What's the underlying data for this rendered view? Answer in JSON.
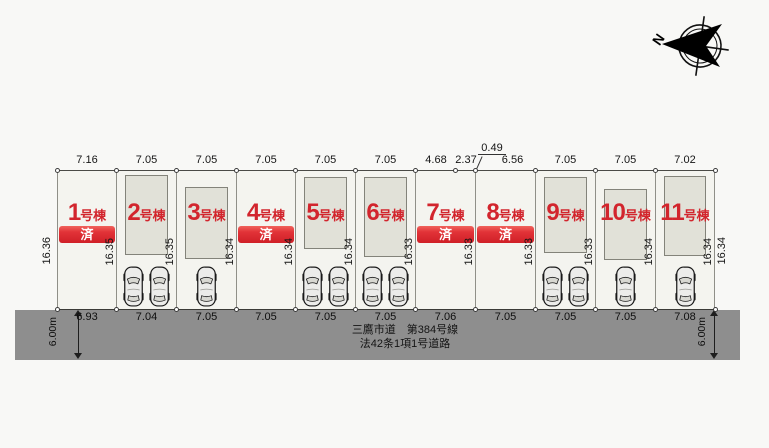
{
  "compass": {
    "label": "N"
  },
  "road": {
    "line1": "三鷹市道　第384号線",
    "line2": "法42条1項1号道路",
    "width_left": "6.00m",
    "width_right": "6.00m"
  },
  "outer_dims": {
    "left": "16.36",
    "right": "16.34"
  },
  "lots": [
    {
      "num": "1",
      "suffix": "号棟",
      "sold": "済",
      "top1": "7.16",
      "bottom": "6.93",
      "side": "16.35",
      "cars": 0,
      "building": false
    },
    {
      "num": "2",
      "suffix": "号棟",
      "top1": "7.05",
      "bottom": "7.04",
      "side": "16.35",
      "cars": 2,
      "building": true
    },
    {
      "num": "3",
      "suffix": "号棟",
      "top1": "7.05",
      "bottom": "7.05",
      "side": "16.34",
      "cars": 1,
      "building": true
    },
    {
      "num": "4",
      "suffix": "号棟",
      "sold": "済",
      "top1": "7.05",
      "bottom": "7.05",
      "side": "16.34",
      "cars": 0,
      "building": false
    },
    {
      "num": "5",
      "suffix": "号棟",
      "top1": "7.05",
      "bottom": "7.05",
      "side": "16.34",
      "cars": 2,
      "building": true
    },
    {
      "num": "6",
      "suffix": "号棟",
      "top1": "7.05",
      "bottom": "7.05",
      "side": "16.33",
      "cars": 2,
      "building": true
    },
    {
      "num": "7",
      "suffix": "号棟",
      "sold": "済",
      "top1": "4.68",
      "top2": "2.37",
      "bottom": "7.06",
      "side": "16.33",
      "cars": 0,
      "building": false
    },
    {
      "num": "8",
      "suffix": "号棟",
      "sold": "済",
      "jog": "0.49",
      "top1": "6.56",
      "bottom": "7.05",
      "side": "16.33",
      "cars": 0,
      "building": false
    },
    {
      "num": "9",
      "suffix": "号棟",
      "top1": "7.05",
      "bottom": "7.05",
      "side": "16.33",
      "cars": 2,
      "building": true
    },
    {
      "num": "10",
      "suffix": "号棟",
      "top1": "7.05",
      "bottom": "7.05",
      "side": "16.34",
      "cars": 1,
      "building": true
    },
    {
      "num": "11",
      "suffix": "号棟",
      "top1": "7.02",
      "bottom": "7.08",
      "side": "16.34",
      "cars": 1,
      "building": true
    }
  ],
  "colors": {
    "accent_red": "#d2252d",
    "banner_red_top": "#f0635c",
    "banner_red_bottom": "#cf1f27",
    "road_gray": "#8e8e8e",
    "building_fill": "#e1e1d8",
    "lot_fill": "#f4f4ef",
    "background": "#f8f8f6"
  }
}
